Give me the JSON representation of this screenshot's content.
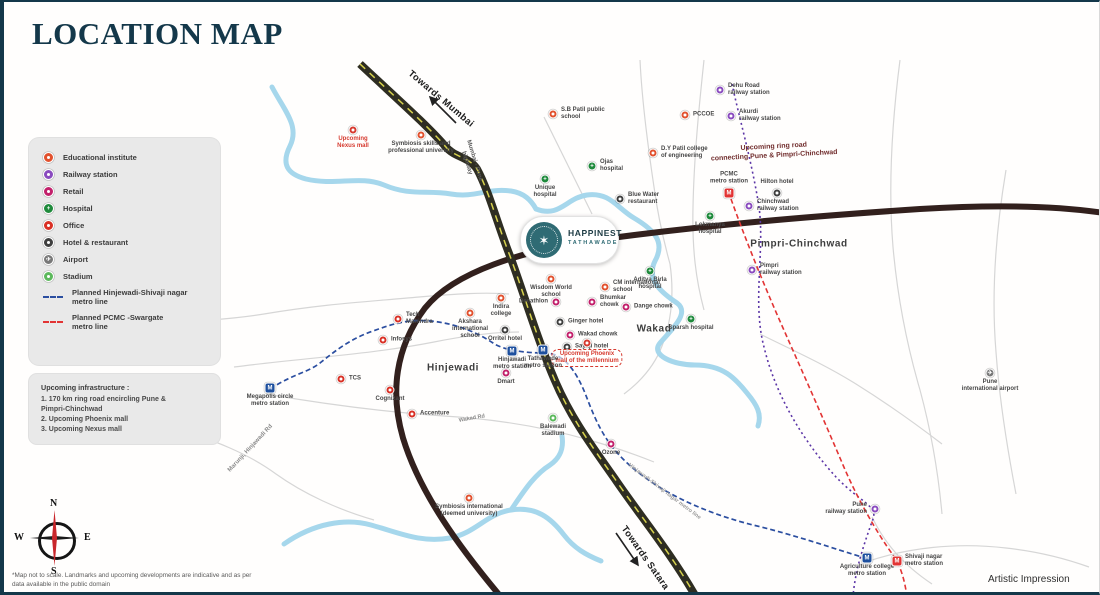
{
  "header": {
    "title": "LOCATION MAP"
  },
  "logo": {
    "line1": "HAPPINEST",
    "line2": "TATHAWADE"
  },
  "compass": {
    "n": "N",
    "s": "S",
    "e": "E",
    "w": "W"
  },
  "footer": {
    "disclaimer": "*Map not to scale. Landmarks and upcoming developments are indicative and as per data available in the public domain",
    "artistic": "Artistic Impression"
  },
  "colors": {
    "accent": "#14384a",
    "panel": "#e9e9e9",
    "ring_road": "#32201d",
    "highway": "#2e2d22",
    "river": "#a6d7ec",
    "metro_blue": "#2b4ea0",
    "metro_red": "#e23434",
    "railway_purple": "#5b35a6",
    "edu": "#e2512e",
    "rail": "#8a4bbf",
    "retail": "#c2206b",
    "hospital": "#1f8a3c",
    "office": "#d93025",
    "hotel": "#3f3f3f",
    "airport": "#787878",
    "stadium": "#5cb85c",
    "upcoming": "#d63a2f"
  },
  "legend": {
    "items": [
      {
        "type": "edu",
        "label": "Educational institute"
      },
      {
        "type": "rail",
        "label": "Railway station"
      },
      {
        "type": "retail",
        "label": "Retail"
      },
      {
        "type": "hospital",
        "label": "Hospital"
      },
      {
        "type": "office",
        "label": "Office"
      },
      {
        "type": "hotel",
        "label": "Hotel & restaurant"
      },
      {
        "type": "airport",
        "label": "Airport"
      },
      {
        "type": "stadium",
        "label": "Stadium"
      },
      {
        "type": "line-blue",
        "label": "Planned Hinjewadi-Shivaji nagar\nmetro line"
      },
      {
        "type": "line-red",
        "label": "Planned PCMC -Swargate\nmetro line"
      }
    ]
  },
  "infrastructure": {
    "title": "Upcoming infrastructure :",
    "lines": [
      "1. 170 km ring road encircling Pune &",
      "    Pimpri-Chinchwad",
      "2. Upcoming Phoenix mall",
      "3. Upcoming Nexus mall"
    ]
  },
  "map": {
    "area_labels": [
      {
        "name": "area-hinjewadi",
        "text": "Hinjewadi",
        "x": 449,
        "y": 366
      },
      {
        "name": "area-wakad",
        "text": "Wakad",
        "x": 650,
        "y": 327
      },
      {
        "name": "area-pimpri-chinchwad",
        "text": "Pimpri-Chinchwad",
        "x": 795,
        "y": 242
      }
    ],
    "direction_labels": [
      {
        "name": "label-towards-mumbai",
        "text": "Towards Mumbai",
        "x": 437,
        "y": 97,
        "rot": 40
      },
      {
        "name": "label-towards-satara",
        "text": "Towards Satara",
        "x": 641,
        "y": 556,
        "rot": 55
      }
    ],
    "road_labels": [
      {
        "name": "label-mumbai-pune-highway",
        "text": "Mumbai - Pune\nhighway",
        "x": 466,
        "y": 160,
        "rot": 73,
        "color": "#5a5a5a",
        "size": 6
      },
      {
        "name": "label-ring-road",
        "text": "Upcoming ring road\nconnecting Pune & Pimpri-Chinchwad",
        "x": 770,
        "y": 150,
        "rot": -3,
        "color": "#702c2c",
        "size": 7
      },
      {
        "name": "label-marunji-road",
        "text": "Marunji, Hinjawadi Rd",
        "x": 247,
        "y": 447,
        "rot": -47,
        "color": "#8a8a8a",
        "size": 6
      },
      {
        "name": "label-wakad-road",
        "text": "Wakad Rd",
        "x": 468,
        "y": 417,
        "rot": -10,
        "color": "#8a8a8a",
        "size": 5.5
      },
      {
        "name": "label-metro-line",
        "text": "Hinjawadi-Shivaji nagar metro line",
        "x": 660,
        "y": 490,
        "rot": 37,
        "color": "#9a9a9a",
        "size": 5.5
      }
    ],
    "pois": [
      {
        "name": "upcoming-mall-nw",
        "type": "upcoming",
        "x": 349,
        "y": 128,
        "label": "Upcoming\nNexus mall",
        "labelPos": "below",
        "labelColor": "#d63a2f"
      },
      {
        "name": "symbiosis-skills-university",
        "type": "edu",
        "x": 417,
        "y": 133,
        "label": "Symbiosis skills and\nprofessional university",
        "labelPos": "below"
      },
      {
        "name": "sb-patil-public-school",
        "type": "edu",
        "x": 549,
        "y": 112,
        "label": "S.B Patil public\nschool",
        "labelPos": "right"
      },
      {
        "name": "pccoe",
        "type": "edu",
        "x": 681,
        "y": 113,
        "label": "PCCOE",
        "labelPos": "right"
      },
      {
        "name": "dehu-road-railway-station",
        "type": "rail",
        "x": 716,
        "y": 88,
        "label": "Dehu Road\nrailway station",
        "labelPos": "right"
      },
      {
        "name": "akurdi-railway-station",
        "type": "rail",
        "x": 727,
        "y": 114,
        "label": "Akurdi\nrailway station",
        "labelPos": "right"
      },
      {
        "name": "dy-patil-college",
        "type": "edu",
        "x": 649,
        "y": 151,
        "label": "D.Y Patil college\nof engineering",
        "labelPos": "right"
      },
      {
        "name": "ojas-hospital",
        "type": "hospital",
        "x": 588,
        "y": 164,
        "label": "Ojas\nhospital",
        "labelPos": "right"
      },
      {
        "name": "unique-hospital",
        "type": "hospital",
        "x": 541,
        "y": 177,
        "label": "Unique\nhospital",
        "labelPos": "below"
      },
      {
        "name": "blue-water-restaurant",
        "type": "hotel",
        "x": 616,
        "y": 197,
        "label": "Blue Water\nrestaurant",
        "labelPos": "right"
      },
      {
        "name": "pcmc-metro-station",
        "type": "metro-red",
        "x": 725,
        "y": 191,
        "label": "PCMC\nmetro station",
        "labelPos": "above"
      },
      {
        "name": "hilton-hotel",
        "type": "hotel",
        "x": 773,
        "y": 191,
        "label": "Hilton hotel",
        "labelPos": "above"
      },
      {
        "name": "chinchwad-railway-station",
        "type": "rail",
        "x": 745,
        "y": 204,
        "label": "Chinchwad\nrailway station",
        "labelPos": "right"
      },
      {
        "name": "lokmanya-hospital",
        "type": "hospital",
        "x": 706,
        "y": 214,
        "label": "Lokmanya\nhospital",
        "labelPos": "below"
      },
      {
        "name": "pimpri-railway-station",
        "type": "rail",
        "x": 748,
        "y": 268,
        "label": "Pimpri\nrailway station",
        "labelPos": "right"
      },
      {
        "name": "wisdom-world-school",
        "type": "edu",
        "x": 547,
        "y": 277,
        "label": "Wisdom World\nschool",
        "labelPos": "below"
      },
      {
        "name": "cm-international-school",
        "type": "edu",
        "x": 601,
        "y": 285,
        "label": "CM international\nschool",
        "labelPos": "right"
      },
      {
        "name": "aditya-birla-hospital",
        "type": "hospital",
        "x": 646,
        "y": 269,
        "label": "Aditya Birla\nhospital",
        "labelPos": "below"
      },
      {
        "name": "decathlon",
        "type": "retail",
        "x": 552,
        "y": 300,
        "label": "Decathlon",
        "labelPos": "left"
      },
      {
        "name": "bhumkar-chowk",
        "type": "retail",
        "x": 588,
        "y": 300,
        "label": "Bhumkar\nchowk",
        "labelPos": "right"
      },
      {
        "name": "ginger-hotel",
        "type": "hotel",
        "x": 556,
        "y": 320,
        "label": "Ginger hotel",
        "labelPos": "right"
      },
      {
        "name": "wakad-chowk",
        "type": "retail",
        "x": 566,
        "y": 333,
        "label": "Wakad chowk",
        "labelPos": "right"
      },
      {
        "name": "dange-chowk",
        "type": "retail",
        "x": 622,
        "y": 305,
        "label": "Dange chowk",
        "labelPos": "right"
      },
      {
        "name": "sayaji-hotel",
        "type": "hotel",
        "x": 563,
        "y": 345,
        "label": "Sayaji hotel",
        "labelPos": "right"
      },
      {
        "name": "upcoming-phoenix-mall",
        "type": "upcoming",
        "x": 583,
        "y": 341,
        "label": "Upcoming Phoenix\nmall of the millennium",
        "labelPos": "below",
        "labelColor": "#d63a2f",
        "boxed": true
      },
      {
        "name": "sparsh-hospital",
        "type": "hospital",
        "x": 687,
        "y": 317,
        "label": "Sparsh hospital",
        "labelPos": "below"
      },
      {
        "name": "indira-college",
        "type": "edu",
        "x": 497,
        "y": 296,
        "label": "Indira\ncollege",
        "labelPos": "below"
      },
      {
        "name": "akshara-international-school",
        "type": "edu",
        "x": 466,
        "y": 311,
        "label": "Akshara\ninternational\nschool",
        "labelPos": "below"
      },
      {
        "name": "orritel-hotel",
        "type": "hotel",
        "x": 501,
        "y": 328,
        "label": "Orritel hotel",
        "labelPos": "below"
      },
      {
        "name": "hinjawadi-metro-station",
        "type": "metro-blue",
        "x": 508,
        "y": 349,
        "label": "Hinjawadi\nmetro station",
        "labelPos": "below"
      },
      {
        "name": "tathawade-metro-station",
        "type": "metro-blue",
        "x": 539,
        "y": 348,
        "label": "Tathawade\nmetro station",
        "labelPos": "below"
      },
      {
        "name": "dmart",
        "type": "retail",
        "x": 502,
        "y": 371,
        "label": "Dmart",
        "labelPos": "below"
      },
      {
        "name": "tech-mahindra",
        "type": "office",
        "x": 394,
        "y": 317,
        "label": "Tech\nMahindra",
        "labelPos": "right"
      },
      {
        "name": "infosys",
        "type": "office",
        "x": 379,
        "y": 338,
        "label": "Infosys",
        "labelPos": "right"
      },
      {
        "name": "tcs",
        "type": "office",
        "x": 337,
        "y": 377,
        "label": "TCS",
        "labelPos": "right"
      },
      {
        "name": "cognizant",
        "type": "office",
        "x": 386,
        "y": 388,
        "label": "Cognizant",
        "labelPos": "below"
      },
      {
        "name": "accenture",
        "type": "office",
        "x": 408,
        "y": 412,
        "label": "Accenture",
        "labelPos": "right"
      },
      {
        "name": "megapolis-circle-metro-station",
        "type": "metro-blue",
        "x": 266,
        "y": 386,
        "label": "Megapolis circle\nmetro station",
        "labelPos": "below"
      },
      {
        "name": "balewadi-stadium",
        "type": "stadium",
        "x": 549,
        "y": 416,
        "label": "Balewadi\nstadium",
        "labelPos": "below"
      },
      {
        "name": "ozone",
        "type": "retail",
        "x": 607,
        "y": 442,
        "label": "Ozone",
        "labelPos": "below"
      },
      {
        "name": "symbiosis-international-university",
        "type": "edu",
        "x": 465,
        "y": 496,
        "label": "Symbiosis international\n(deemed university)",
        "labelPos": "below"
      },
      {
        "name": "pune-international-airport",
        "type": "airport",
        "x": 986,
        "y": 371,
        "label": "Pune\ninternational airport",
        "labelPos": "below"
      },
      {
        "name": "pune-railway-station",
        "type": "rail",
        "x": 871,
        "y": 507,
        "label": "Pune\nrailway station",
        "labelPos": "left"
      },
      {
        "name": "agriculture-college-metro-station",
        "type": "metro-blue",
        "x": 863,
        "y": 556,
        "label": "Agriculture college\nmetro station",
        "labelPos": "below"
      },
      {
        "name": "shivaji-nagar-metro-station",
        "type": "metro-red",
        "x": 893,
        "y": 559,
        "label": "Shivaji nagar\nmetro station",
        "labelPos": "right"
      }
    ]
  }
}
